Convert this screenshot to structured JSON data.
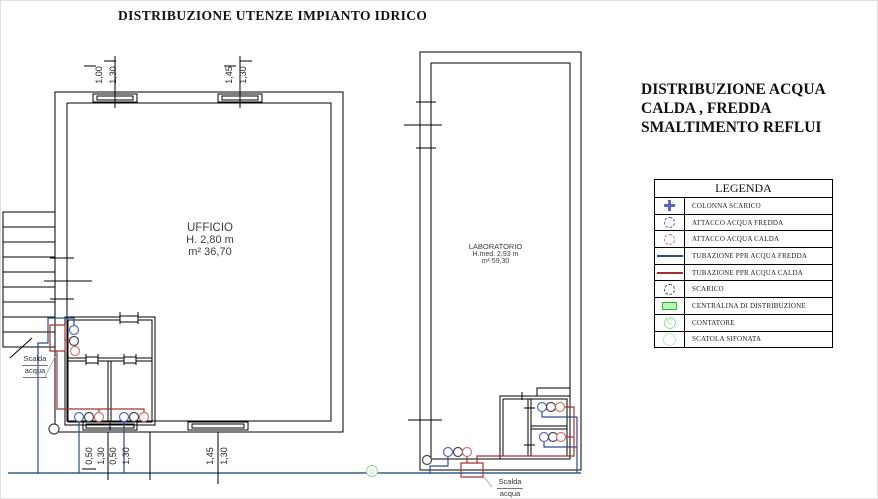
{
  "title": "DISTRIBUZIONE UTENZE IMPIANTO IDRICO",
  "subtitle": {
    "line1": "DISTRIBUZIONE ACQUA",
    "line2": "CALDA , FREDDA",
    "line3": "SMALTIMENTO REFLUI"
  },
  "legend": {
    "title": "LEGENDA",
    "items": [
      {
        "symbol": "colonna-scarico-cross",
        "label": "COLONNA SCARICO"
      },
      {
        "symbol": "attacco-acqua-fredda-circle",
        "label": "ATTACCO ACQUA FREDDA"
      },
      {
        "symbol": "attacco-acqua-calda-circle",
        "label": "ATTACCO ACQUA CALDA"
      },
      {
        "symbol": "tubazione-fredda-line",
        "label": "TUBAZIONE PPR ACQUA FREDDA"
      },
      {
        "symbol": "tubazione-calda-line",
        "label": "TUBAZIONE PPR ACQUA CALDA"
      },
      {
        "symbol": "scarico-circle",
        "label": "SCARICO"
      },
      {
        "symbol": "centralina-rect",
        "label": "CENTRALINA DI DISTRIBUZIONE"
      },
      {
        "symbol": "contatore-circle",
        "label": "CONTATORE",
        "letter": "C"
      },
      {
        "symbol": "scatola-sifonata-circle",
        "label": "SCATOLA SIFONATA"
      }
    ]
  },
  "rooms": {
    "ufficio": {
      "name": "UFFICIO",
      "height": "H. 2,80 m",
      "area": "m² 36,70"
    },
    "laboratorio": {
      "name": "LABORATORIO",
      "height": "H.med. 2,93 m",
      "area": "m² 59,30"
    }
  },
  "labels": {
    "scalda_acqua_line1": "Scalda",
    "scalda_acqua_line2": "acqua",
    "contatore_letter": "C"
  },
  "dimensions": {
    "office_top": [
      "1,00",
      "1,30",
      "1,45",
      "1,30"
    ],
    "office_bottom": [
      "0,50",
      "1,30",
      "0,50",
      "1,30",
      "1,45",
      "1,30"
    ]
  },
  "colors": {
    "wall": "#000000",
    "cold_water": "#2b4a8b",
    "hot_water": "#a03232",
    "main_line": "#336088",
    "fixture_cold": "#5566cc",
    "fixture_hot": "#cc7777",
    "fixture_drain": "#444444",
    "green_device": "#2db82d",
    "green_light": "#9ade9a"
  }
}
